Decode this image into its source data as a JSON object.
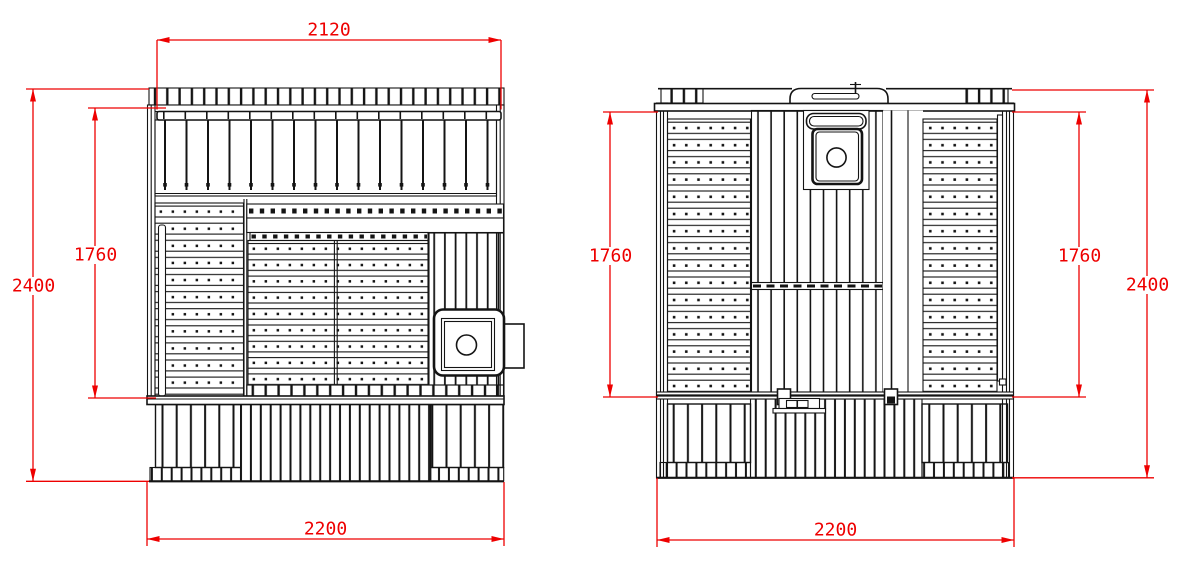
{
  "colors": {
    "background": "#ffffff",
    "drawing_line": "#141414",
    "dimension": "#ee0000"
  },
  "left_view": {
    "dim_top_width": "2120",
    "dim_overall_height": "2400",
    "dim_interior_height": "1760",
    "dim_base_width": "2200"
  },
  "right_view": {
    "dim_interior_height_left": "1760",
    "dim_interior_height_right": "1760",
    "dim_overall_height": "2400",
    "dim_base_width": "2200"
  }
}
